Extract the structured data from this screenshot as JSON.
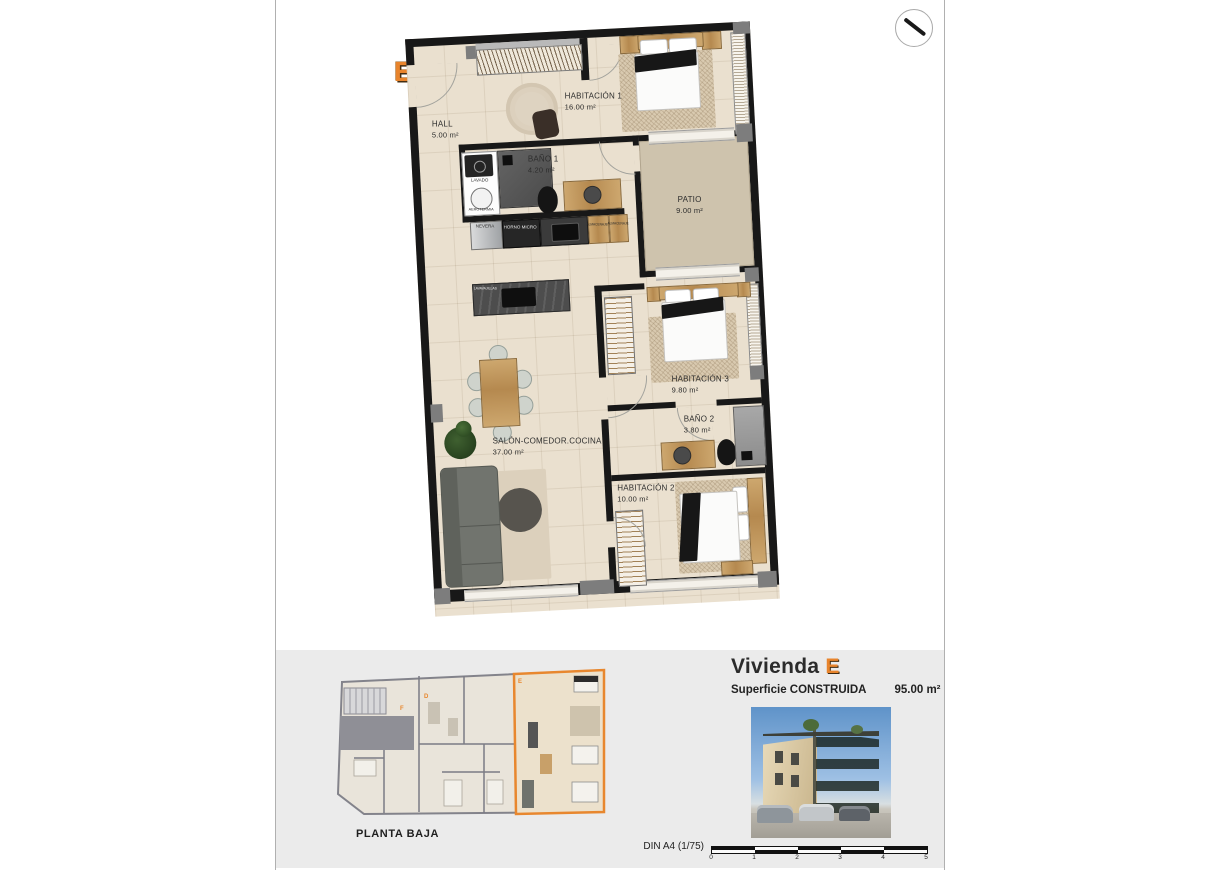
{
  "document": {
    "unit_letter": "E"
  },
  "plan": {
    "rooms": [
      {
        "name": "HALL",
        "area": "5.00 m²"
      },
      {
        "name": "HABITACIÓN 1",
        "area": "16.00 m²"
      },
      {
        "name": "BAÑO 1",
        "area": "4.20 m²"
      },
      {
        "name": "PATIO",
        "area": "9.00 m²"
      },
      {
        "name": "SALÓN-COMEDOR.COCINA",
        "area": "37.00 m²"
      },
      {
        "name": "HABITACIÓN 3",
        "area": "9.80 m²"
      },
      {
        "name": "BAÑO 2",
        "area": "3.80 m²"
      },
      {
        "name": "HABITACIÓN 2",
        "area": "10.00 m²"
      }
    ],
    "fixtures": {
      "fridge": "NEVERA",
      "oven": "HORNO MICRO",
      "storage_a": "ALMACENAJE",
      "storage_b": "ALMACENAJE",
      "laundry": "LAVADO",
      "heat_pump": "AEROTERMIA",
      "dishwasher": "LAVAVAJILLAS"
    }
  },
  "footer": {
    "overview_caption": "PLANTA BAJA",
    "overview_units": {
      "e": "E",
      "f": "F",
      "d": "D"
    },
    "title_prefix": "Vivienda",
    "title_letter": "E",
    "surface_label": "Superficie CONSTRUIDA",
    "surface_value": "95.00 m²",
    "scale_label": "DIN A4 (1/75)",
    "scale_ticks": [
      "0",
      "1",
      "2",
      "3",
      "4",
      "5"
    ]
  },
  "colors": {
    "accent_orange": "#E8842C",
    "wall_black": "#181818",
    "floor_beige": "#EAE0CF",
    "patio_beige": "#CEC3AD",
    "panel_gray": "#EBEBEB"
  }
}
